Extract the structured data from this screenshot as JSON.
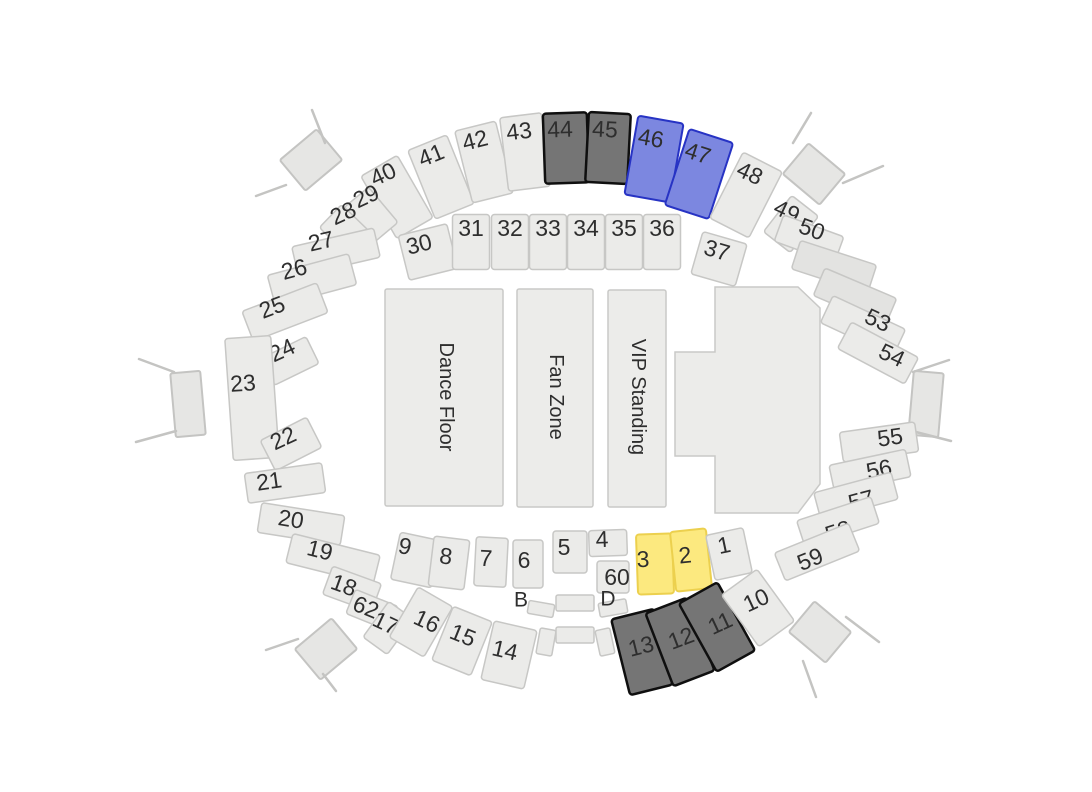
{
  "canvas": {
    "width": 1092,
    "height": 792,
    "background": "#ffffff"
  },
  "styles": {
    "light": {
      "fill": "#ebebe9",
      "stroke": "#c7c7c5",
      "sw": 1.5
    },
    "muted": {
      "fill": "#e3e3e1",
      "stroke": "#c7c7c5",
      "sw": 1.5
    },
    "dark": {
      "fill": "#757575",
      "stroke": "#0f0f0f",
      "sw": 2.5
    },
    "blue": {
      "fill": "#7c87e0",
      "stroke": "#2733c4",
      "sw": 2
    },
    "yellow": {
      "fill": "#fce97f",
      "stroke": "#ecd04e",
      "sw": 2
    },
    "floor": {
      "fill": "#ececea",
      "stroke": "#c9c9c7",
      "sw": 1.5
    },
    "entrance": {
      "fill": "#e6e6e4",
      "stroke": "#c4c4c2",
      "sw": 2
    },
    "label_color": "#2e2e2e",
    "section_font_size": 23,
    "floor_font_size": 20,
    "aisle_font_size": 21
  },
  "floors": [
    {
      "id": "dance-floor",
      "label": "Dance Floor",
      "x": 385,
      "y": 289,
      "w": 118,
      "h": 217,
      "lx": 446,
      "ly": 397
    },
    {
      "id": "fan-zone",
      "label": "Fan Zone",
      "x": 517,
      "y": 289,
      "w": 76,
      "h": 218,
      "lx": 556,
      "ly": 397
    },
    {
      "id": "vip-standing",
      "label": "VIP Standing",
      "x": 608,
      "y": 290,
      "w": 58,
      "h": 217,
      "lx": 638,
      "ly": 397
    }
  ],
  "stage": {
    "points": [
      [
        715,
        287
      ],
      [
        798,
        287
      ],
      [
        820,
        308
      ],
      [
        820,
        484
      ],
      [
        798,
        513
      ],
      [
        715,
        513
      ],
      [
        715,
        456
      ],
      [
        675,
        456
      ],
      [
        675,
        352
      ],
      [
        715,
        352
      ]
    ]
  },
  "section_columns": [
    "label",
    "style",
    "cx",
    "cy",
    "w",
    "h",
    "rot",
    "lx",
    "ly"
  ],
  "sections": [
    [
      "40",
      "light",
      397,
      197,
      42,
      72,
      -30,
      383,
      174
    ],
    [
      "41",
      "light",
      441,
      177,
      42,
      74,
      -22,
      431,
      155
    ],
    [
      "42",
      "light",
      484,
      162,
      42,
      74,
      -14,
      475,
      140
    ],
    [
      "43",
      "light",
      525,
      152,
      42,
      74,
      -7,
      519,
      131
    ],
    [
      "44",
      "dark",
      566,
      148,
      44,
      70,
      -2,
      560,
      129
    ],
    [
      "45",
      "dark",
      608,
      148,
      42,
      70,
      3,
      605,
      129
    ],
    [
      "46",
      "blue",
      654,
      159,
      46,
      80,
      10,
      651,
      138
    ],
    [
      "47",
      "blue",
      699,
      174,
      46,
      80,
      18,
      698,
      153
    ],
    [
      "48",
      "light",
      746,
      195,
      44,
      74,
      27,
      750,
      173
    ],
    [
      "29",
      "light",
      371,
      215,
      32,
      46,
      -40,
      366,
      196
    ],
    [
      "28",
      "light",
      347,
      232,
      32,
      46,
      -46,
      343,
      213
    ],
    [
      "27",
      "light",
      336,
      252,
      84,
      30,
      -13,
      321,
      241
    ],
    [
      "26",
      "light",
      312,
      280,
      84,
      32,
      -15,
      294,
      269
    ],
    [
      "25",
      "light",
      285,
      312,
      80,
      32,
      -21,
      272,
      307
    ],
    [
      "24",
      "light",
      290,
      361,
      50,
      30,
      -26,
      282,
      350
    ],
    [
      "23",
      "light",
      252,
      398,
      46,
      122,
      -4,
      243,
      383
    ],
    [
      "22",
      "light",
      291,
      444,
      52,
      34,
      -27,
      283,
      438
    ],
    [
      "21",
      "light",
      285,
      483,
      78,
      30,
      -8,
      269,
      481
    ],
    [
      "20",
      "light",
      301,
      524,
      84,
      30,
      9,
      291,
      519
    ],
    [
      "19",
      "light",
      333,
      559,
      90,
      30,
      14,
      320,
      550
    ],
    [
      "18",
      "light",
      352,
      589,
      52,
      30,
      20,
      344,
      585
    ],
    [
      "62",
      "light",
      372,
      610,
      46,
      26,
      22,
      366,
      607
    ],
    [
      "17",
      "light",
      388,
      628,
      30,
      44,
      36,
      386,
      623
    ],
    [
      "16",
      "light",
      421,
      622,
      40,
      58,
      30,
      427,
      621
    ],
    [
      "15",
      "light",
      462,
      641,
      42,
      58,
      22,
      463,
      635
    ],
    [
      "14",
      "light",
      509,
      655,
      44,
      60,
      13,
      505,
      650
    ],
    [
      "30",
      "light",
      428,
      252,
      50,
      46,
      -14,
      419,
      244
    ],
    [
      "31",
      "light",
      471,
      242,
      37,
      55,
      0,
      471,
      228
    ],
    [
      "32",
      "light",
      510,
      242,
      37,
      55,
      0,
      510,
      228
    ],
    [
      "33",
      "light",
      548,
      242,
      37,
      55,
      0,
      548,
      228
    ],
    [
      "34",
      "light",
      586,
      242,
      37,
      55,
      0,
      586,
      228
    ],
    [
      "35",
      "light",
      624,
      242,
      37,
      55,
      0,
      624,
      228
    ],
    [
      "36",
      "light",
      662,
      242,
      37,
      55,
      0,
      662,
      228
    ],
    [
      "37",
      "light",
      719,
      259,
      46,
      44,
      16,
      717,
      250
    ],
    [
      "9",
      "light",
      416,
      560,
      42,
      48,
      12,
      405,
      546
    ],
    [
      "8",
      "light",
      449,
      563,
      36,
      50,
      7,
      446,
      556
    ],
    [
      "7",
      "light",
      491,
      562,
      32,
      49,
      3,
      486,
      558
    ],
    [
      "6",
      "light",
      528,
      564,
      30,
      48,
      0,
      524,
      560
    ],
    [
      "5",
      "light",
      570,
      552,
      34,
      42,
      0,
      564,
      547
    ],
    [
      "4",
      "light",
      608,
      543,
      38,
      26,
      -2,
      602,
      539
    ],
    [
      "60",
      "light",
      613,
      577,
      32,
      32,
      0,
      617,
      577
    ],
    [
      "3",
      "yellow",
      655,
      564,
      36,
      60,
      -2,
      643,
      559
    ],
    [
      "2",
      "yellow",
      691,
      560,
      36,
      60,
      -6,
      685,
      555
    ],
    [
      "1",
      "light",
      729,
      554,
      38,
      46,
      -12,
      724,
      545
    ],
    [
      "13",
      "dark",
      642,
      652,
      44,
      78,
      -14,
      641,
      646
    ],
    [
      "12",
      "dark",
      680,
      642,
      44,
      78,
      -21,
      681,
      638
    ],
    [
      "11",
      "dark",
      717,
      627,
      44,
      78,
      -29,
      720,
      623
    ],
    [
      "10",
      "light",
      758,
      608,
      44,
      64,
      -36,
      756,
      600
    ],
    [
      "49",
      "light",
      791,
      224,
      34,
      46,
      38,
      787,
      211
    ],
    [
      "50",
      "light",
      809,
      239,
      64,
      28,
      20,
      812,
      229
    ],
    [
      "",
      "muted",
      834,
      267,
      80,
      30,
      18,
      0,
      0
    ],
    [
      "",
      "muted",
      855,
      297,
      78,
      30,
      23,
      0,
      0
    ],
    [
      "53",
      "light",
      863,
      326,
      80,
      30,
      25,
      878,
      320
    ],
    [
      "54",
      "light",
      878,
      353,
      76,
      30,
      28,
      892,
      355
    ],
    [
      "55",
      "light",
      879,
      442,
      76,
      30,
      -8,
      890,
      437
    ],
    [
      "56",
      "light",
      870,
      471,
      78,
      28,
      -12,
      879,
      469
    ],
    [
      "57",
      "light",
      856,
      496,
      80,
      28,
      -15,
      861,
      500
    ],
    [
      "58",
      "light",
      838,
      522,
      78,
      28,
      -18,
      838,
      531
    ],
    [
      "59",
      "light",
      817,
      552,
      80,
      30,
      -22,
      810,
      559
    ]
  ],
  "aisle_labels": [
    {
      "text": "B",
      "x": 521,
      "y": 600
    },
    {
      "text": "D",
      "x": 608,
      "y": 599
    }
  ],
  "aisle_shapes": [
    [
      575,
      603,
      38,
      16,
      0
    ],
    [
      575,
      635,
      38,
      16,
      0
    ],
    [
      541,
      609,
      26,
      13,
      10
    ],
    [
      613,
      608,
      28,
      14,
      -10
    ],
    [
      546,
      642,
      16,
      26,
      10
    ],
    [
      605,
      642,
      15,
      26,
      -12
    ]
  ],
  "entrances": [
    {
      "id": "top-left",
      "cx": 311,
      "cy": 160,
      "w": 48,
      "h": 40,
      "rot": -40,
      "lines": [
        [
          312,
          110,
          325,
          143
        ],
        [
          256,
          196,
          286,
          185
        ]
      ]
    },
    {
      "id": "left",
      "cx": 188,
      "cy": 404,
      "w": 30,
      "h": 64,
      "rot": -5,
      "lines": [
        [
          139,
          359,
          174,
          372
        ],
        [
          136,
          442,
          176,
          431
        ]
      ]
    },
    {
      "id": "bottom-left",
      "cx": 326,
      "cy": 649,
      "w": 48,
      "h": 40,
      "rot": -40,
      "lines": [
        [
          266,
          650,
          298,
          639
        ],
        [
          323,
          674,
          336,
          691
        ]
      ]
    },
    {
      "id": "top-right",
      "cx": 814,
      "cy": 174,
      "w": 48,
      "h": 40,
      "rot": 40,
      "lines": [
        [
          811,
          113,
          793,
          143
        ],
        [
          843,
          183,
          883,
          166
        ]
      ]
    },
    {
      "id": "right",
      "cx": 926,
      "cy": 404,
      "w": 30,
      "h": 64,
      "rot": 5,
      "lines": [
        [
          949,
          360,
          913,
          372
        ],
        [
          951,
          441,
          912,
          431
        ]
      ]
    },
    {
      "id": "bottom-right",
      "cx": 820,
      "cy": 632,
      "w": 48,
      "h": 40,
      "rot": 40,
      "lines": [
        [
          846,
          617,
          879,
          642
        ],
        [
          803,
          661,
          816,
          697
        ]
      ]
    }
  ]
}
